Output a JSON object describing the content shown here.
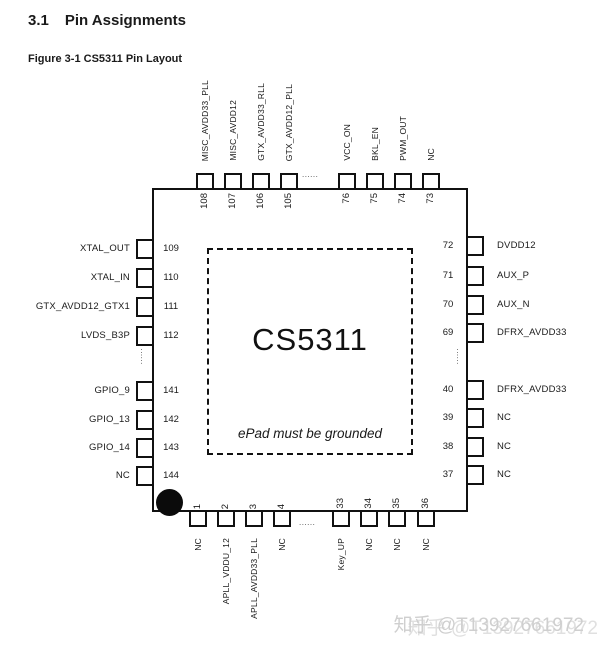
{
  "page": {
    "section_number": "3.1",
    "section_title": "Pin Assignments",
    "figure_caption": "Figure 3-1 CS5311 Pin Layout"
  },
  "chip": {
    "name": "CS5311",
    "epad_note": "ePad must be grounded"
  },
  "diagram": {
    "ellipsis_h": "......",
    "ellipsis_v": "......"
  },
  "pins": {
    "top": [
      {
        "num": "108",
        "label": "MISC_AVDD33_PLL"
      },
      {
        "num": "107",
        "label": "MISC_AVDD12"
      },
      {
        "num": "106",
        "label": "GTX_AVDD33_RLL"
      },
      {
        "num": "105",
        "label": "GTX_AVDD12_PLL"
      },
      {
        "num": "76",
        "label": "VCC_ON"
      },
      {
        "num": "75",
        "label": "BKL_EN"
      },
      {
        "num": "74",
        "label": "PWM_OUT"
      },
      {
        "num": "73",
        "label": "NC"
      }
    ],
    "left": [
      {
        "num": "109",
        "label": "XTAL_OUT"
      },
      {
        "num": "110",
        "label": "XTAL_IN"
      },
      {
        "num": "111",
        "label": "GTX_AVDD12_GTX1"
      },
      {
        "num": "112",
        "label": "LVDS_B3P"
      },
      {
        "num": "141",
        "label": "GPIO_9"
      },
      {
        "num": "142",
        "label": "GPIO_13"
      },
      {
        "num": "143",
        "label": "GPIO_14"
      },
      {
        "num": "144",
        "label": "NC"
      }
    ],
    "right": [
      {
        "num": "72",
        "label": "DVDD12"
      },
      {
        "num": "71",
        "label": "AUX_P"
      },
      {
        "num": "70",
        "label": "AUX_N"
      },
      {
        "num": "69",
        "label": "DFRX_AVDD33"
      },
      {
        "num": "40",
        "label": "DFRX_AVDD33"
      },
      {
        "num": "39",
        "label": "NC"
      },
      {
        "num": "38",
        "label": "NC"
      },
      {
        "num": "37",
        "label": "NC"
      }
    ],
    "bottom": [
      {
        "num": "1",
        "label": "NC"
      },
      {
        "num": "2",
        "label": "APLL_VDDU_12"
      },
      {
        "num": "3",
        "label": "APLL_AVDD33_PLL"
      },
      {
        "num": "4",
        "label": "NC"
      },
      {
        "num": "33",
        "label": "Key_UP"
      },
      {
        "num": "34",
        "label": "NC"
      },
      {
        "num": "35",
        "label": "NC"
      },
      {
        "num": "36",
        "label": "NC"
      }
    ]
  },
  "watermark": {
    "text": "知乎 @T13927661972",
    "color": "#cfcfcf"
  }
}
